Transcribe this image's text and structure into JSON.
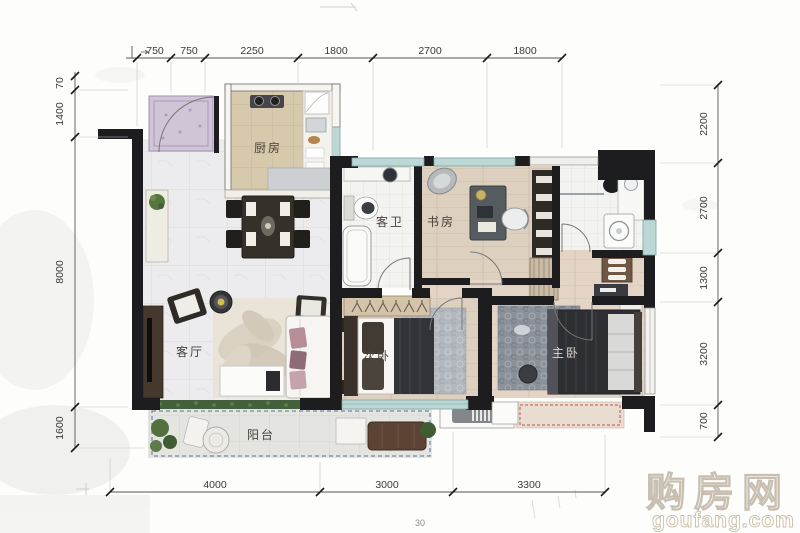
{
  "document": {
    "type": "apartment-floor-plan"
  },
  "rooms": [
    {
      "id": "kitchen",
      "label": "厨房"
    },
    {
      "id": "guest-bathroom",
      "label": "客卫"
    },
    {
      "id": "study",
      "label": "书房"
    },
    {
      "id": "living-room",
      "label": "客厅"
    },
    {
      "id": "second-bedroom",
      "label": "次卧"
    },
    {
      "id": "master-bedroom",
      "label": "主卧"
    },
    {
      "id": "balcony",
      "label": "阳台"
    }
  ],
  "dims": {
    "top": [
      "750",
      "750",
      "2250",
      "1800",
      "2700",
      "1800"
    ],
    "left": [
      "70",
      "1400",
      "8000",
      "1600"
    ],
    "right": [
      "2200",
      "2700",
      "1300",
      "3200",
      "700"
    ],
    "bottom": [
      "4000",
      "3000",
      "3300"
    ],
    "stray": "30"
  },
  "watermark": {
    "name": "购房网",
    "url": "goufang.com"
  },
  "colors": {
    "wall": "#1d1d1f",
    "window": "#bcd8d6",
    "balcony_dash": "#6f87a8",
    "platform_dash": "#c2554d",
    "watermark_outline": "#c8bfb0"
  }
}
